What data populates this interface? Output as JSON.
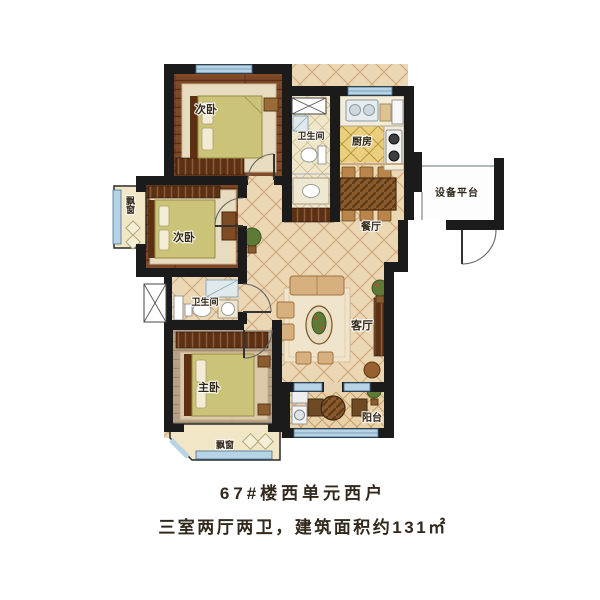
{
  "unit_info": {
    "title": "67#楼西单元西户",
    "description": "三室两厅两卫，建筑面积约131㎡"
  },
  "rooms": {
    "bedroom_top": "次卧",
    "bedroom_middle": "次卧",
    "master_bedroom": "主卧",
    "bathroom_top": "卫生间",
    "bathroom_middle": "卫生间",
    "kitchen": "厨房",
    "dining_room": "餐厅",
    "living_room": "客厅",
    "balcony": "阳台",
    "equipment_platform": "设备平台",
    "bay_window_left": "飘窗",
    "bay_window_bottom": "飘窗"
  },
  "colors": {
    "wall": "#1b1b1b",
    "window_glass": "#b7d3e6",
    "wood_floor": "#7c4827",
    "tile_floor": "#ecd7b4",
    "kitchen_tile": "#eacf7f",
    "bed_cover": "#cbc478",
    "bay_sill": "#f1e6c6",
    "caption_text": "#474747"
  }
}
